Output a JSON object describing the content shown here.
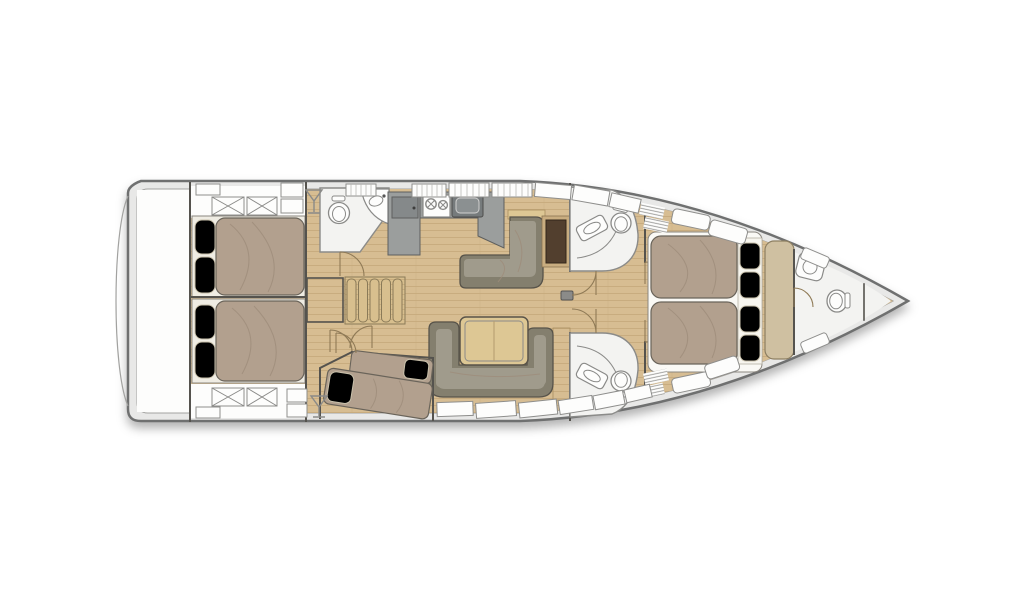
{
  "diagram": {
    "kind": "sailing-yacht-interior-floor-plan",
    "orientation": {
      "bow": "right",
      "stern": "left"
    },
    "rooms": [
      {
        "name": "swim-platform"
      },
      {
        "name": "aft-cabin-port",
        "furniture": [
          "double-bed",
          "pillows",
          "hatch-locker"
        ]
      },
      {
        "name": "aft-cabin-starboard",
        "furniture": [
          "double-bed",
          "pillows",
          "hatch-locker"
        ]
      },
      {
        "name": "aft-head",
        "furniture": [
          "toilet",
          "washbasin"
        ]
      },
      {
        "name": "companionway",
        "furniture": [
          "stairs-5-treads",
          "landing"
        ]
      },
      {
        "name": "galley",
        "furniture": [
          "fridge",
          "stove-2-burners",
          "sink",
          "counter"
        ]
      },
      {
        "name": "salon-settee",
        "furniture": [
          "l-shaped-sofa",
          "chart-table"
        ]
      },
      {
        "name": "salon-dinette",
        "furniture": [
          "u-shaped-sofa",
          "dining-table"
        ]
      },
      {
        "name": "berth-cabin",
        "furniture": [
          "single-berth",
          "single-berth",
          "pillows"
        ]
      },
      {
        "name": "head-starboard",
        "furniture": [
          "toilet",
          "vanity-basin",
          "quarter-round-shower"
        ]
      },
      {
        "name": "head-port",
        "furniture": [
          "toilet",
          "vanity-basin",
          "quarter-round-shower"
        ]
      },
      {
        "name": "owner-cabin",
        "furniture": [
          "island-double-bed",
          "pillows",
          "chaise-bench",
          "side-shelves",
          "vent-grilles"
        ]
      },
      {
        "name": "bow-head",
        "furniture": [
          "washbasin",
          "toilet"
        ]
      },
      {
        "name": "anchor-locker"
      }
    ],
    "icons": [
      "martini-glass-icon",
      "martini-glass-icon",
      "burner-icon",
      "faucet-icon"
    ],
    "counts": {
      "cabins": 4,
      "berths": 5,
      "heads": 4,
      "toilets": 4,
      "basins": 4
    }
  },
  "palette": {
    "deckBand": "#e8e8e7",
    "hullStroke": "#6f7070",
    "innerStroke": "#a2a2a0",
    "white": "#fdfdfc",
    "headFloor": "#f3f3f1",
    "floorWood": "#d7bd92",
    "floorWoodLine": "#c4a779",
    "wall": "#55534e",
    "bed": "#b2a08e",
    "bedBorder": "#6a645a",
    "bedCrease": "#9e8c7a",
    "pillow": "#f2edе0",
    "pillowFix": "#f2ede0",
    "pillowBorder": "#c9c1ab",
    "sofa": "#948f80",
    "sofaBack": "#847f6e",
    "sofaSeat": "#a09b8c",
    "sofaBorder": "#57534a",
    "tableWood": "#ddc794",
    "tableBorder": "#5a5449",
    "counter": "#9b9e9d",
    "applianceStroke": "#5e5f5e",
    "applianceDark": "#767b7c",
    "chartTable": "#523f2e",
    "chartBorder": "#32261a",
    "chartFrame": "#c9ad80",
    "tanSeat": "#cfc0a1",
    "tanBorder": "#8d7f62",
    "fixture": "#8a8a88",
    "doorArc": "#8f7a56",
    "lockerBorder": "#8e8e8c",
    "slatLine": "#b8b8b6",
    "stairWood": "#d8bf8e",
    "stairBorder": "#8a7a58"
  }
}
